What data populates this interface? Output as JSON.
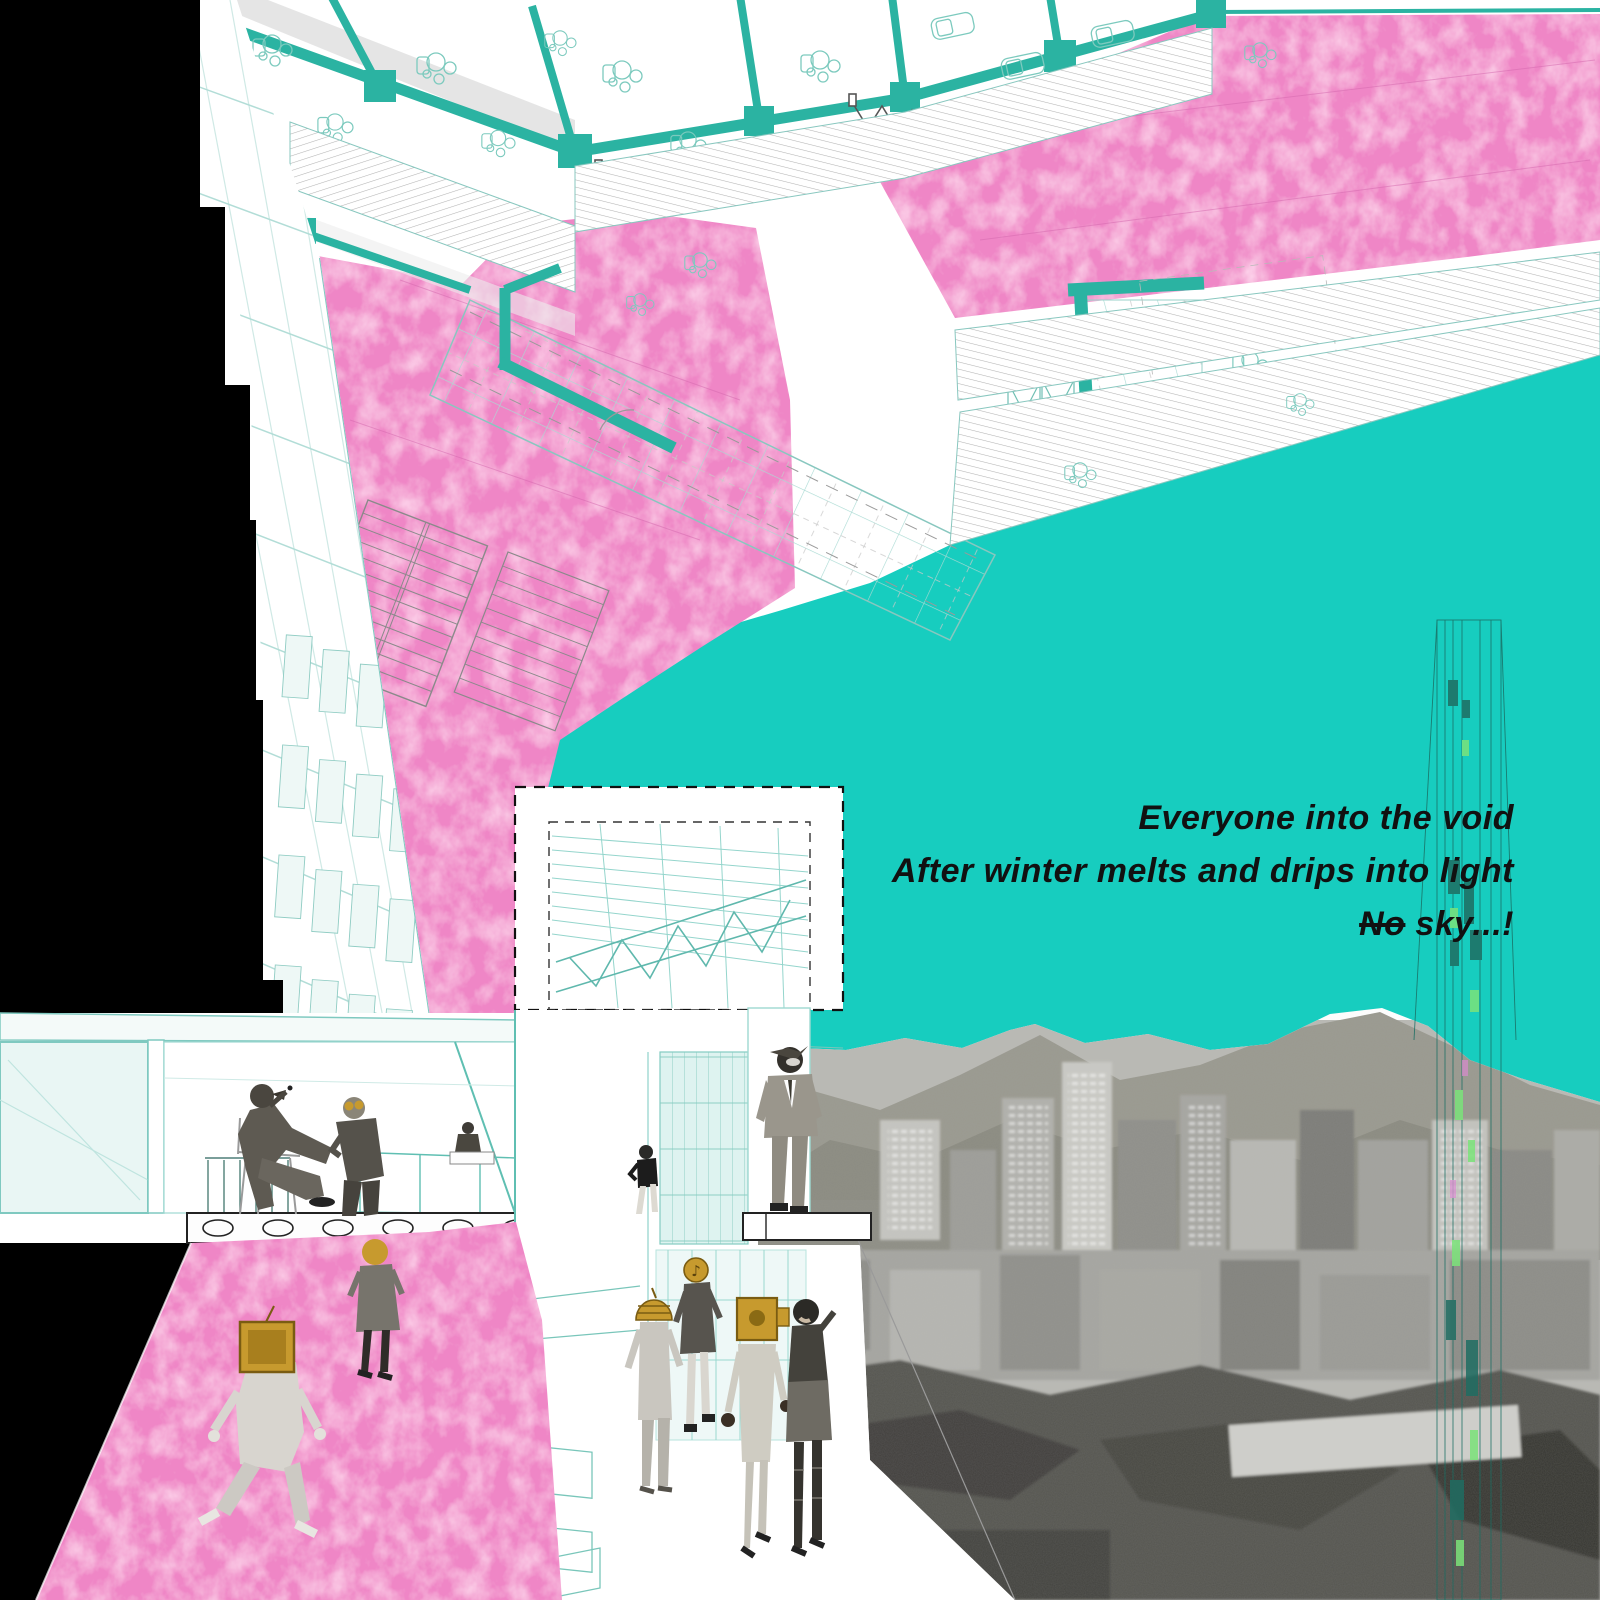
{
  "poem": {
    "line1": "Everyone into the void",
    "line2": "After winter melts and drips into light",
    "line3_strike": "No",
    "line3_rest": " sky...!"
  },
  "palette": {
    "void_teal": "#17cdbf",
    "wall_teal": "#2bb3a2",
    "line_teal": "#9ed9d1",
    "line_teal_strong": "#5fbfb2",
    "pink": "#ef86c6",
    "pink_deep": "#e96bbd",
    "gold": "#c79a2e",
    "ink": "#111111",
    "paper": "#ffffff",
    "hatch_gray": "#9a9a9a",
    "shadow_gray": "#dcdcdc",
    "mountain_gray": "#8e8d86",
    "city_gray": "#a8a8a3"
  },
  "figures": [
    "seated-smoker-gasmask",
    "seated-goggles-man",
    "small-reception-figure",
    "standing-suit-man-helmet",
    "mannequin-on-ledge",
    "blonde-woman-on-ramp",
    "tv-head-walker",
    "gold-dome-helmet-figure",
    "note-head-figure",
    "robot-head-woman",
    "dark-hair-robot-leg-woman"
  ],
  "scene": {
    "drawing_type": "architectural collage: rotated floor plan, void, atrium perspective, city photo"
  }
}
